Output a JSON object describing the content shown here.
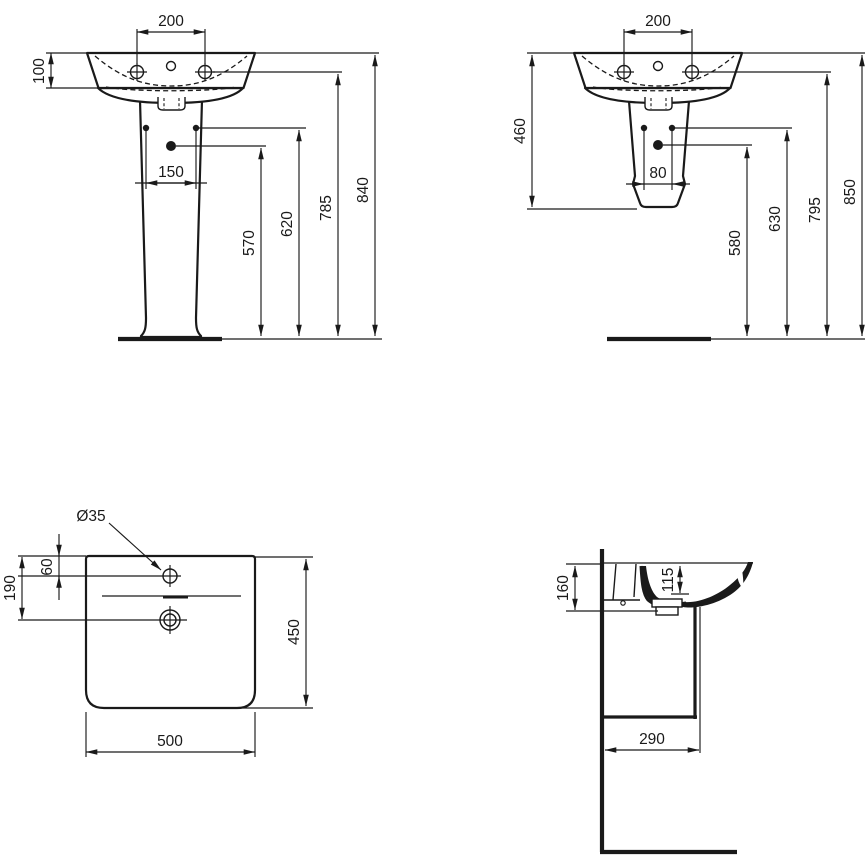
{
  "views": {
    "front_full_pedestal": {
      "dims": {
        "tap_spacing": "200",
        "rim_to_underside": "100",
        "fixing_hole_spacing": "150",
        "trap_outlet_height": "570",
        "fixing_holes_height": "620",
        "tap_holes_height": "785",
        "rim_height": "840"
      }
    },
    "front_semi_pedestal": {
      "dims": {
        "tap_spacing": "200",
        "semi_pedestal_height": "460",
        "fixing_hole_spacing": "80",
        "trap_outlet_height": "580",
        "fixing_holes_height": "630",
        "tap_holes_height": "795",
        "rim_height": "850"
      }
    },
    "plan": {
      "dims": {
        "tap_hole_diameter": "Ø35",
        "tap_hole_from_back": "60",
        "drain_from_back": "190",
        "depth": "450",
        "width": "500"
      }
    },
    "side": {
      "dims": {
        "mounting_height": "160",
        "bowl_depth": "115",
        "outlet_from_wall": "290"
      }
    }
  },
  "colors": {
    "line": "#1a1a1a",
    "background": "#ffffff"
  }
}
